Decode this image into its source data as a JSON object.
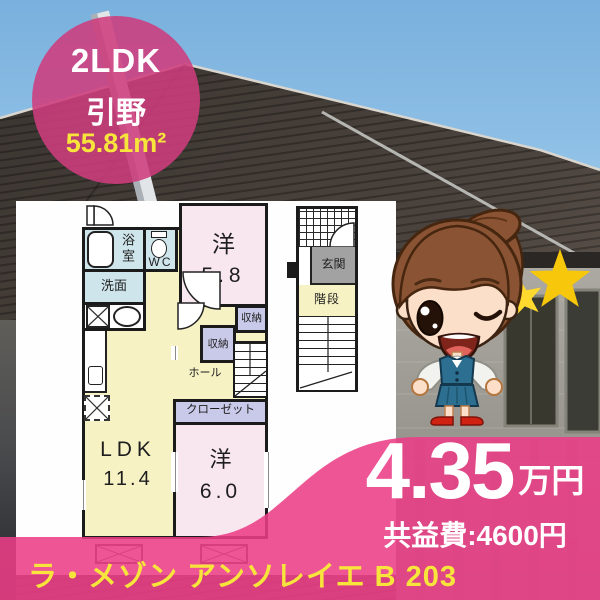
{
  "colors": {
    "pink": "#ec3e86",
    "pink-deep": "#ce3c7d",
    "yellow": "#f7e53c",
    "gold": "#f6c70b",
    "gold-light": "#ffd92e",
    "room-blue": "#cfe5ec",
    "room-pink": "#f8e7ee",
    "room-yellow": "#f7f2c4",
    "room-lavender": "#c9c9e9",
    "genkan-gray": "#a2a2a2",
    "wall": "#1b1b1b"
  },
  "badge": {
    "layout": "2LDK",
    "district": "引野",
    "area": "55.81m²"
  },
  "floorplan": {
    "bath": "浴室",
    "wc": "WC",
    "washroom": "洗面",
    "western1": "洋",
    "western1_size": "5.8",
    "storage_a": "収納",
    "storage_b": "収納",
    "hall": "ホール",
    "closet": "クローゼット",
    "ldk": "LDK",
    "ldk_size": "11.4",
    "western2": "洋",
    "western2_size": "6.0",
    "entrance": "玄関",
    "stairs": "階段"
  },
  "price": {
    "amount": "4.35",
    "unit": "万円",
    "fee": "共益費:4600円"
  },
  "footer": {
    "building_name": "ラ・メゾン アンソレイエ B 203"
  }
}
